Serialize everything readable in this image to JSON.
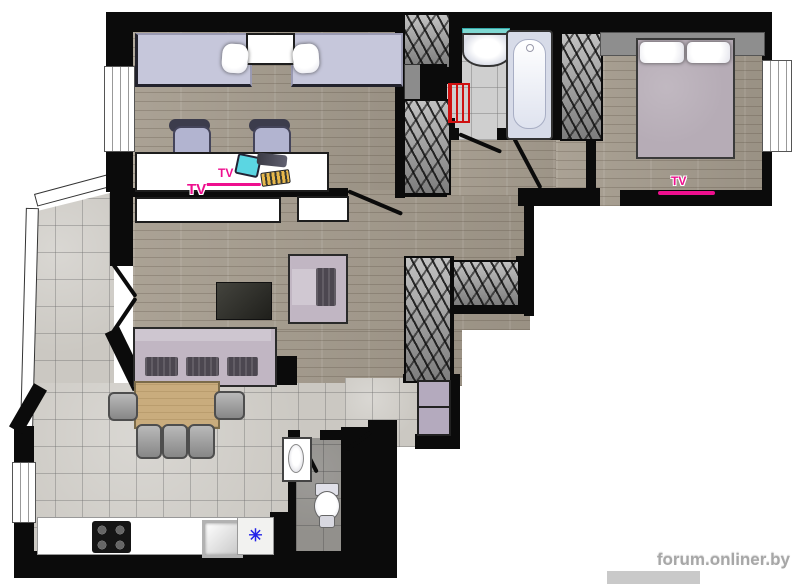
{
  "labels": {
    "tv_kids": "TV",
    "tv_living": "TV",
    "tv_bedroom": "TV"
  },
  "fridge": {
    "symbol": "✳"
  },
  "watermark": {
    "text": "forum.onliner.by"
  },
  "palette": {
    "wall": "#0b0b0b",
    "wood": "#a59c8e",
    "tile": "#cbc8c2",
    "lilac": "#c6c7db",
    "sofa": "#c1b6c3",
    "cushion": "#4c4750",
    "table": "#c9ac7d",
    "magenta": "#ee0f8e",
    "red": "#cf1111",
    "blue": "#2323e8",
    "wardrobe": "#9a9a9a",
    "watermark": "#a7a7a7"
  }
}
